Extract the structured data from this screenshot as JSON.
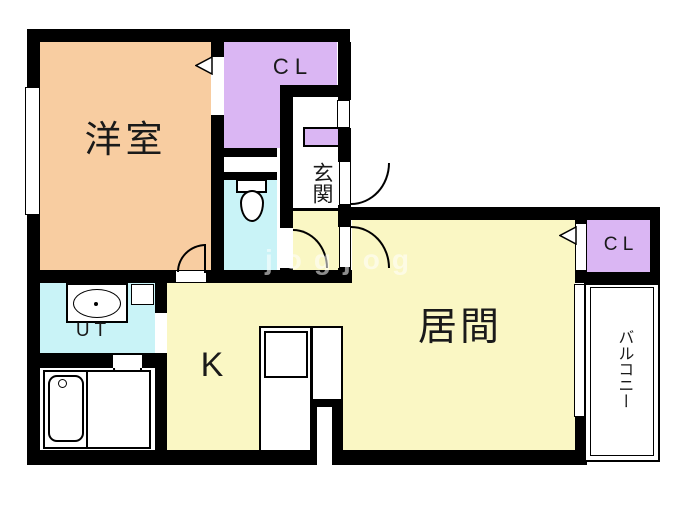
{
  "plan": {
    "rooms": {
      "western": {
        "label": "洋室"
      },
      "closet_top": {
        "label": "C L"
      },
      "closet_right": {
        "label": "C L"
      },
      "entrance": {
        "label": "玄関"
      },
      "utility": {
        "label": "U T"
      },
      "kitchen": {
        "label": "K"
      },
      "living": {
        "label": "居間"
      },
      "balcony": {
        "label": "バルコニー"
      }
    },
    "watermark": "jogjog"
  },
  "colors": {
    "wall": "#000000",
    "western": "#F8CDA1",
    "closet": "#DAB6F3",
    "wet": "#C9F3F7",
    "yellow": "#FAF7C4",
    "balcony": "#FFFFFF"
  }
}
